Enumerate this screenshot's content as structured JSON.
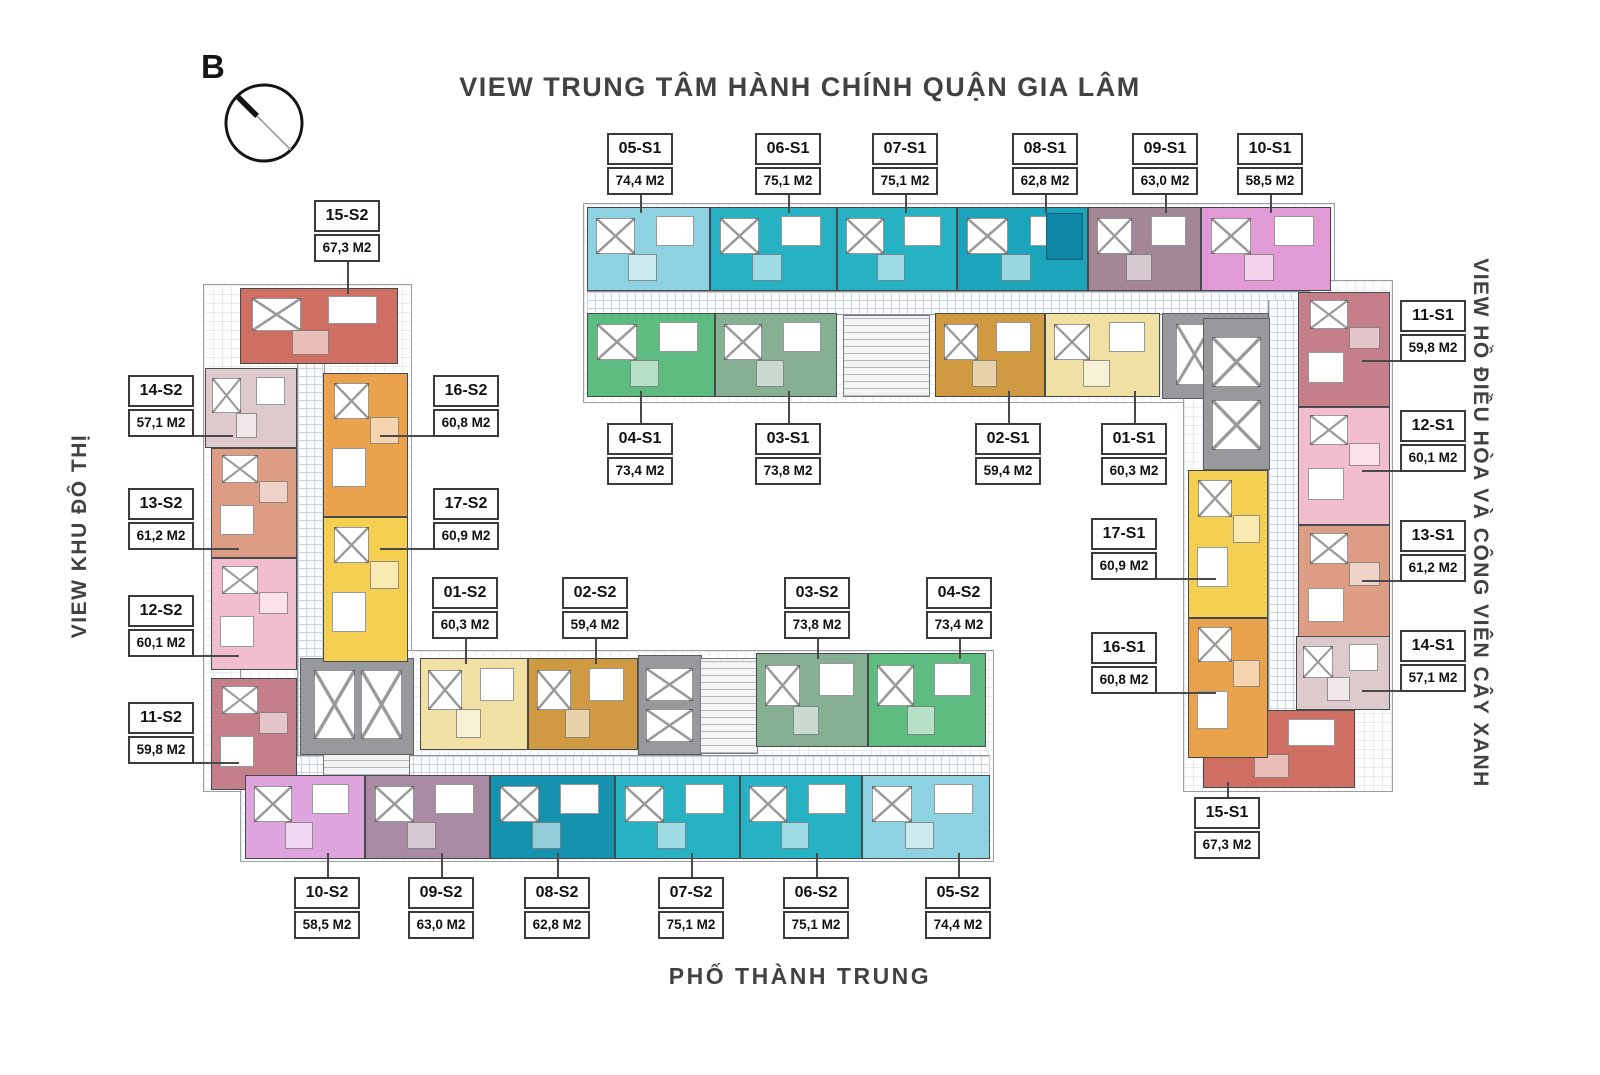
{
  "title": "VIEW TRUNG TÂM HÀNH CHÍNH QUẬN GIA LÂM",
  "compass": {
    "label": "B"
  },
  "views": {
    "left": "VIEW KHU ĐÔ THỊ",
    "right": "VIEW HỒ ĐIỀU HÒA VÀ CÔNG VIÊN CÂY XANH",
    "street": "PHỐ THÀNH TRUNG"
  },
  "units": [
    {
      "id": "05-S1",
      "area": "74,4 M2",
      "color": "#8ed2e1"
    },
    {
      "id": "06-S1",
      "area": "75,1 M2",
      "color": "#27b2c3"
    },
    {
      "id": "07-S1",
      "area": "75,1 M2",
      "color": "#27b2c3"
    },
    {
      "id": "08-S1",
      "area": "62,8 M2",
      "color": "#1ba4ba"
    },
    {
      "id": "09-S1",
      "area": "63,0 M2",
      "color": "#a48796"
    },
    {
      "id": "10-S1",
      "area": "58,5 M2",
      "color": "#e09ad6"
    },
    {
      "id": "04-S1",
      "area": "73,4 M2",
      "color": "#5fbc80"
    },
    {
      "id": "03-S1",
      "area": "73,8 M2",
      "color": "#85b093"
    },
    {
      "id": "02-S1",
      "area": "59,4 M2",
      "color": "#cf9a41"
    },
    {
      "id": "01-S1",
      "area": "60,3 M2",
      "color": "#f1e0a4"
    },
    {
      "id": "11-S1",
      "area": "59,8 M2",
      "color": "#c47f8b"
    },
    {
      "id": "12-S1",
      "area": "60,1 M2",
      "color": "#f3bdd0"
    },
    {
      "id": "13-S1",
      "area": "61,2 M2",
      "color": "#dd9d85"
    },
    {
      "id": "14-S1",
      "area": "57,1 M2",
      "color": "#decacd"
    },
    {
      "id": "15-S1",
      "area": "67,3 M2",
      "color": "#cf6e62"
    },
    {
      "id": "17-S1",
      "area": "60,9 M2",
      "color": "#f4cf52"
    },
    {
      "id": "16-S1",
      "area": "60,8 M2",
      "color": "#eba24c"
    },
    {
      "id": "15-S2",
      "area": "67,3 M2",
      "color": "#cf6e62"
    },
    {
      "id": "14-S2",
      "area": "57,1 M2",
      "color": "#decacd"
    },
    {
      "id": "13-S2",
      "area": "61,2 M2",
      "color": "#dd9d85"
    },
    {
      "id": "12-S2",
      "area": "60,1 M2",
      "color": "#f3bdd0"
    },
    {
      "id": "11-S2",
      "area": "59,8 M2",
      "color": "#c47f8b"
    },
    {
      "id": "16-S2",
      "area": "60,8 M2",
      "color": "#eba24c"
    },
    {
      "id": "17-S2",
      "area": "60,9 M2",
      "color": "#f4cf52"
    },
    {
      "id": "01-S2",
      "area": "60,3 M2",
      "color": "#f1e0a4"
    },
    {
      "id": "02-S2",
      "area": "59,4 M2",
      "color": "#cf9a41"
    },
    {
      "id": "03-S2",
      "area": "73,8 M2",
      "color": "#85b093"
    },
    {
      "id": "04-S2",
      "area": "73,4 M2",
      "color": "#5fbc80"
    },
    {
      "id": "10-S2",
      "area": "58,5 M2",
      "color": "#dda4de"
    },
    {
      "id": "09-S2",
      "area": "63,0 M2",
      "color": "#a98ba3"
    },
    {
      "id": "08-S2",
      "area": "62,8 M2",
      "color": "#1592ad"
    },
    {
      "id": "07-S2",
      "area": "75,1 M2",
      "color": "#27b2c3"
    },
    {
      "id": "06-S2",
      "area": "75,1 M2",
      "color": "#27b2c3"
    },
    {
      "id": "05-S2",
      "area": "74,4 M2",
      "color": "#8ed2e1"
    }
  ]
}
